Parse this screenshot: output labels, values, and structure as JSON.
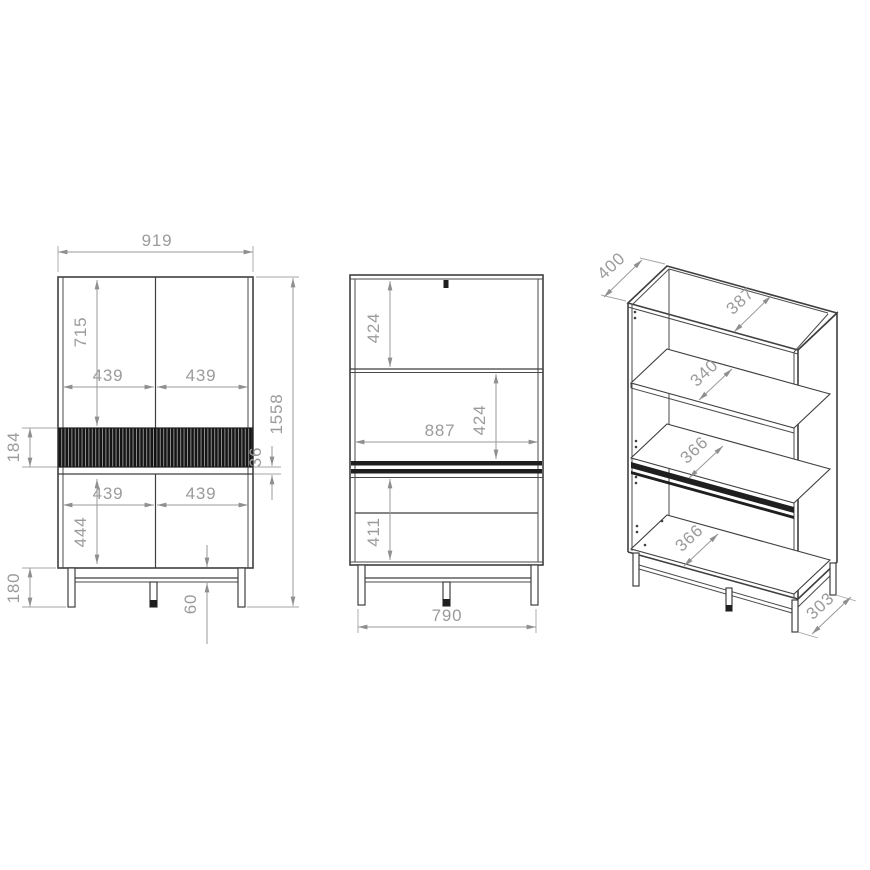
{
  "drawing": {
    "front": {
      "width": "919",
      "upper_door_height": "715",
      "door_widths": [
        "439",
        "439",
        "439",
        "439"
      ],
      "band_height": "184",
      "divider_thickness": "36",
      "lower_door_height": "444",
      "leg_height": "180",
      "rail_clearance": "60",
      "total_height": "1558"
    },
    "section": {
      "upper_compartment": "424",
      "inner_width": "887",
      "middle_compartment": "424",
      "lower_compartment": "411",
      "leg_span": "790"
    },
    "iso": {
      "depth": "400",
      "top_inner_depth": "387",
      "upper_shelf_depth": "340",
      "middle_shelf_depth": "366",
      "bottom_shelf_depth": "366",
      "base_depth": "303"
    }
  },
  "colors": {
    "background": "#ffffff",
    "drawing_line": "#3f3f3f",
    "dimension": "#9b9b9b",
    "band_dark": "#1a1a1a"
  }
}
